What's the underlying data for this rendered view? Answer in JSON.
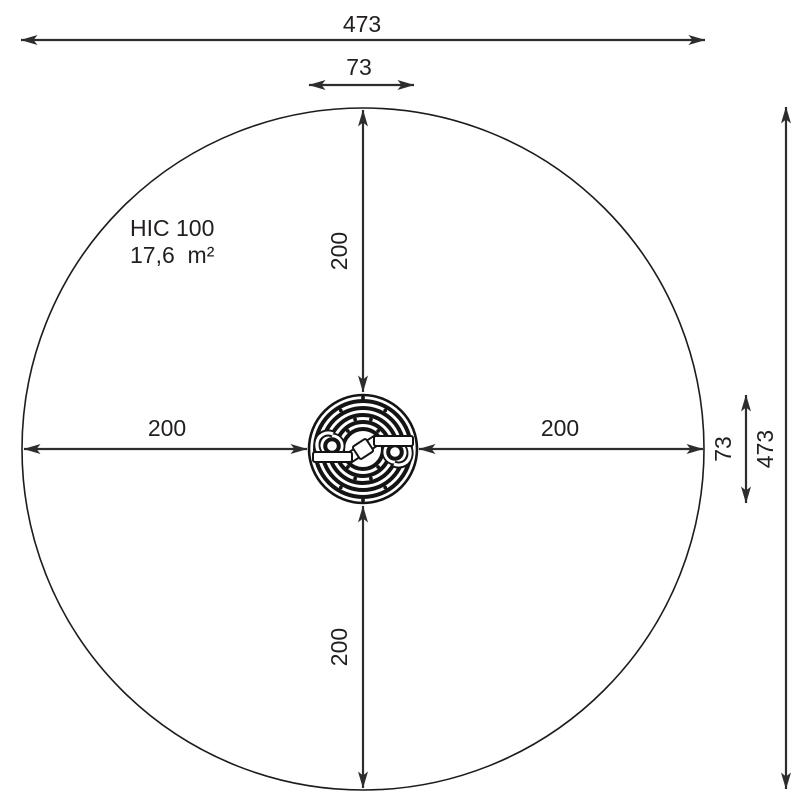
{
  "drawing": {
    "type": "playground-equipment-safety-zone-top-view",
    "labels": {
      "hic": "HIC 100",
      "area": "17,6  m²"
    },
    "dims": {
      "overall_width": "473",
      "overall_height": "473",
      "device_width": "73",
      "device_height": "73",
      "clear_top": "200",
      "clear_bottom": "200",
      "clear_left": "200",
      "clear_right": "200"
    },
    "colors": {
      "dimension_line": "#2d2d2d",
      "drawing_ink": "#141414",
      "text": "#231f20",
      "background": "#ffffff"
    }
  }
}
